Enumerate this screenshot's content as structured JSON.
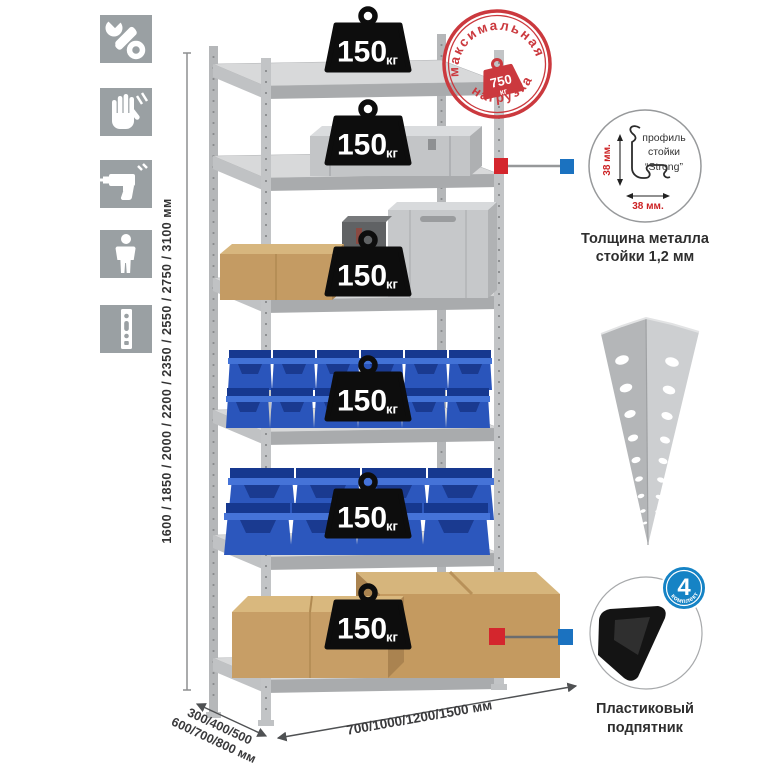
{
  "assembly_icons": [
    "wrench",
    "gloves",
    "drill",
    "person",
    "rack-post"
  ],
  "dimensions": {
    "height_mm": "1600 / 1850 / 2000 / 2200 / 2350 / 2550 / 2750 / 3100 мм",
    "depth_mm_line1": "300/400/500",
    "depth_mm_line2": "600/700/800 мм",
    "width_mm": "700/1000/1200/1500 мм"
  },
  "max_load_stamp": {
    "text_top": "максимальная",
    "text_bottom": "нагрузка",
    "value": "750",
    "unit": "кг"
  },
  "shelves": [
    {
      "load": "150",
      "unit": "кг"
    },
    {
      "load": "150",
      "unit": "кг"
    },
    {
      "load": "150",
      "unit": "кг"
    },
    {
      "load": "150",
      "unit": "кг"
    },
    {
      "load": "150",
      "unit": "кг"
    },
    {
      "load": "150",
      "unit": "кг"
    }
  ],
  "profile_detail": {
    "label_line1": "профиль",
    "label_line2": "стойки",
    "label_line3": "“Strong”",
    "dim_height": "38 мм.",
    "dim_width": "38 мм.",
    "caption_line1": "Толщина металла",
    "caption_line2": "стойки 1,2 мм"
  },
  "foot_detail": {
    "badge_value": "4",
    "badge_arc": "в комплекте",
    "caption_line1": "Пластиковый",
    "caption_line2": "подпятник"
  },
  "colors": {
    "stamp_red": "#cb393e",
    "marker_red": "#d4262d",
    "marker_blue": "#1b72c0",
    "badge_blue": "#1583c5",
    "bin_blue": "#2a55bb",
    "metal_gray": "#c2c4c6"
  }
}
